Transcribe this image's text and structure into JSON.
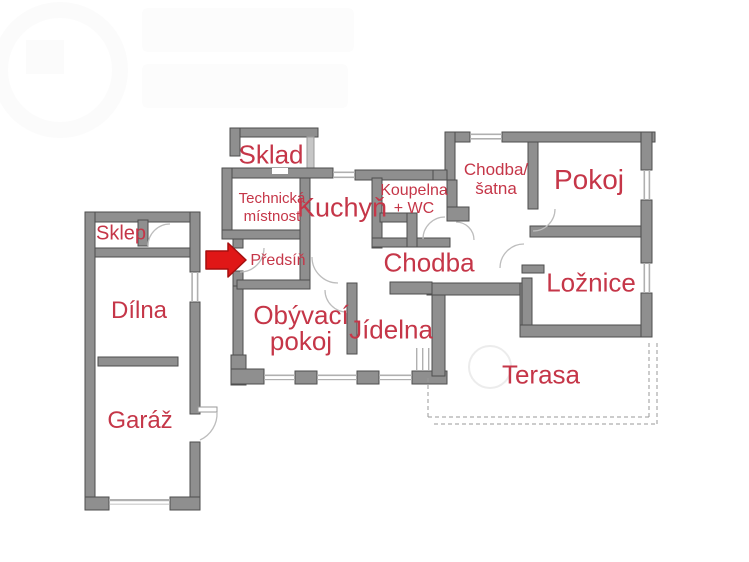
{
  "colors": {
    "label_red": "#c53648",
    "wall_fill": "#8f8f8f",
    "wall_stroke": "#4e4e4e",
    "wall_light": "#c6c6c6",
    "window_line": "#b0b0b0",
    "door_arc": "#bdbdbd",
    "dash_line": "#9a9a9a",
    "arrow_red": "#e01717"
  },
  "rooms": {
    "sklad": {
      "label": "Sklad"
    },
    "technicka": {
      "line1": "Technická",
      "line2": "místnost"
    },
    "kuchyn": {
      "label": "Kuchyň"
    },
    "koupelna": {
      "line1": "Koupelna",
      "line2": "+ WC"
    },
    "chodba_satna": {
      "line1": "Chodba/",
      "line2": "šatna"
    },
    "pokoj": {
      "label": "Pokoj"
    },
    "sklep": {
      "label": "Sklep"
    },
    "predsin": {
      "label": "Předsíň"
    },
    "chodba": {
      "label": "Chodba"
    },
    "loznice": {
      "label": "Ložnice"
    },
    "dilna": {
      "label": "Dílna"
    },
    "obyvaci": {
      "line1": "Obývací",
      "line2": "pokoj"
    },
    "jidelna": {
      "label": "Jídelna"
    },
    "terasa": {
      "label": "Terasa"
    },
    "garaz": {
      "label": "Garáž"
    }
  },
  "entrance_arrow": {
    "points_to_room": "Předsíň"
  }
}
